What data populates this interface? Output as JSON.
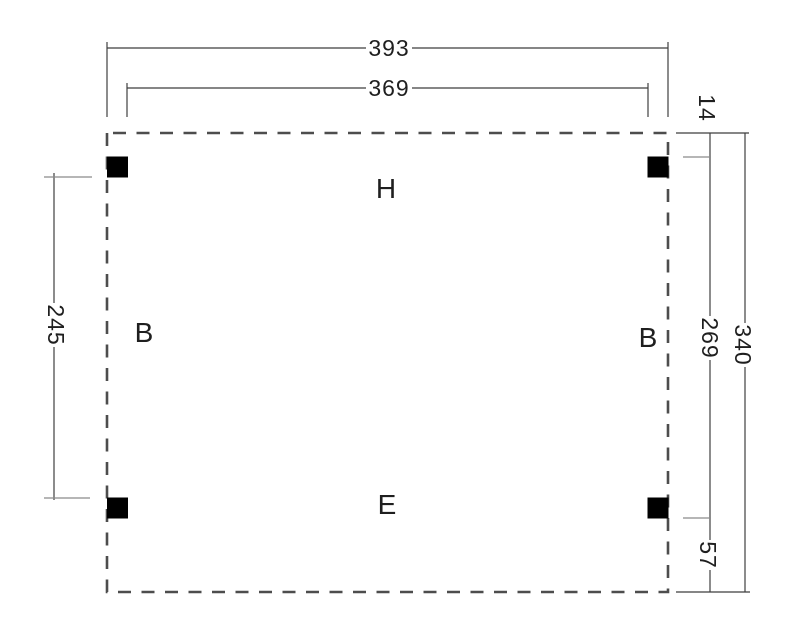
{
  "diagram": {
    "type": "carport-floor-plan",
    "dimensions": {
      "top_outer": "393",
      "top_inner": "369",
      "left_between_posts": "245",
      "right_top_inset": "14",
      "right_between_posts": "269",
      "right_overall": "340",
      "right_bottom_inset": "57"
    },
    "area_labels": {
      "top": "H",
      "left": "B",
      "right": "B",
      "bottom": "E"
    },
    "colors": {
      "background": "#ffffff",
      "outline_dash": "#4d4d4d",
      "post": "#000000",
      "dimension_line": "#3f3f3f",
      "post_tick": "#8a8a8a",
      "text": "#1f1f1f"
    }
  }
}
